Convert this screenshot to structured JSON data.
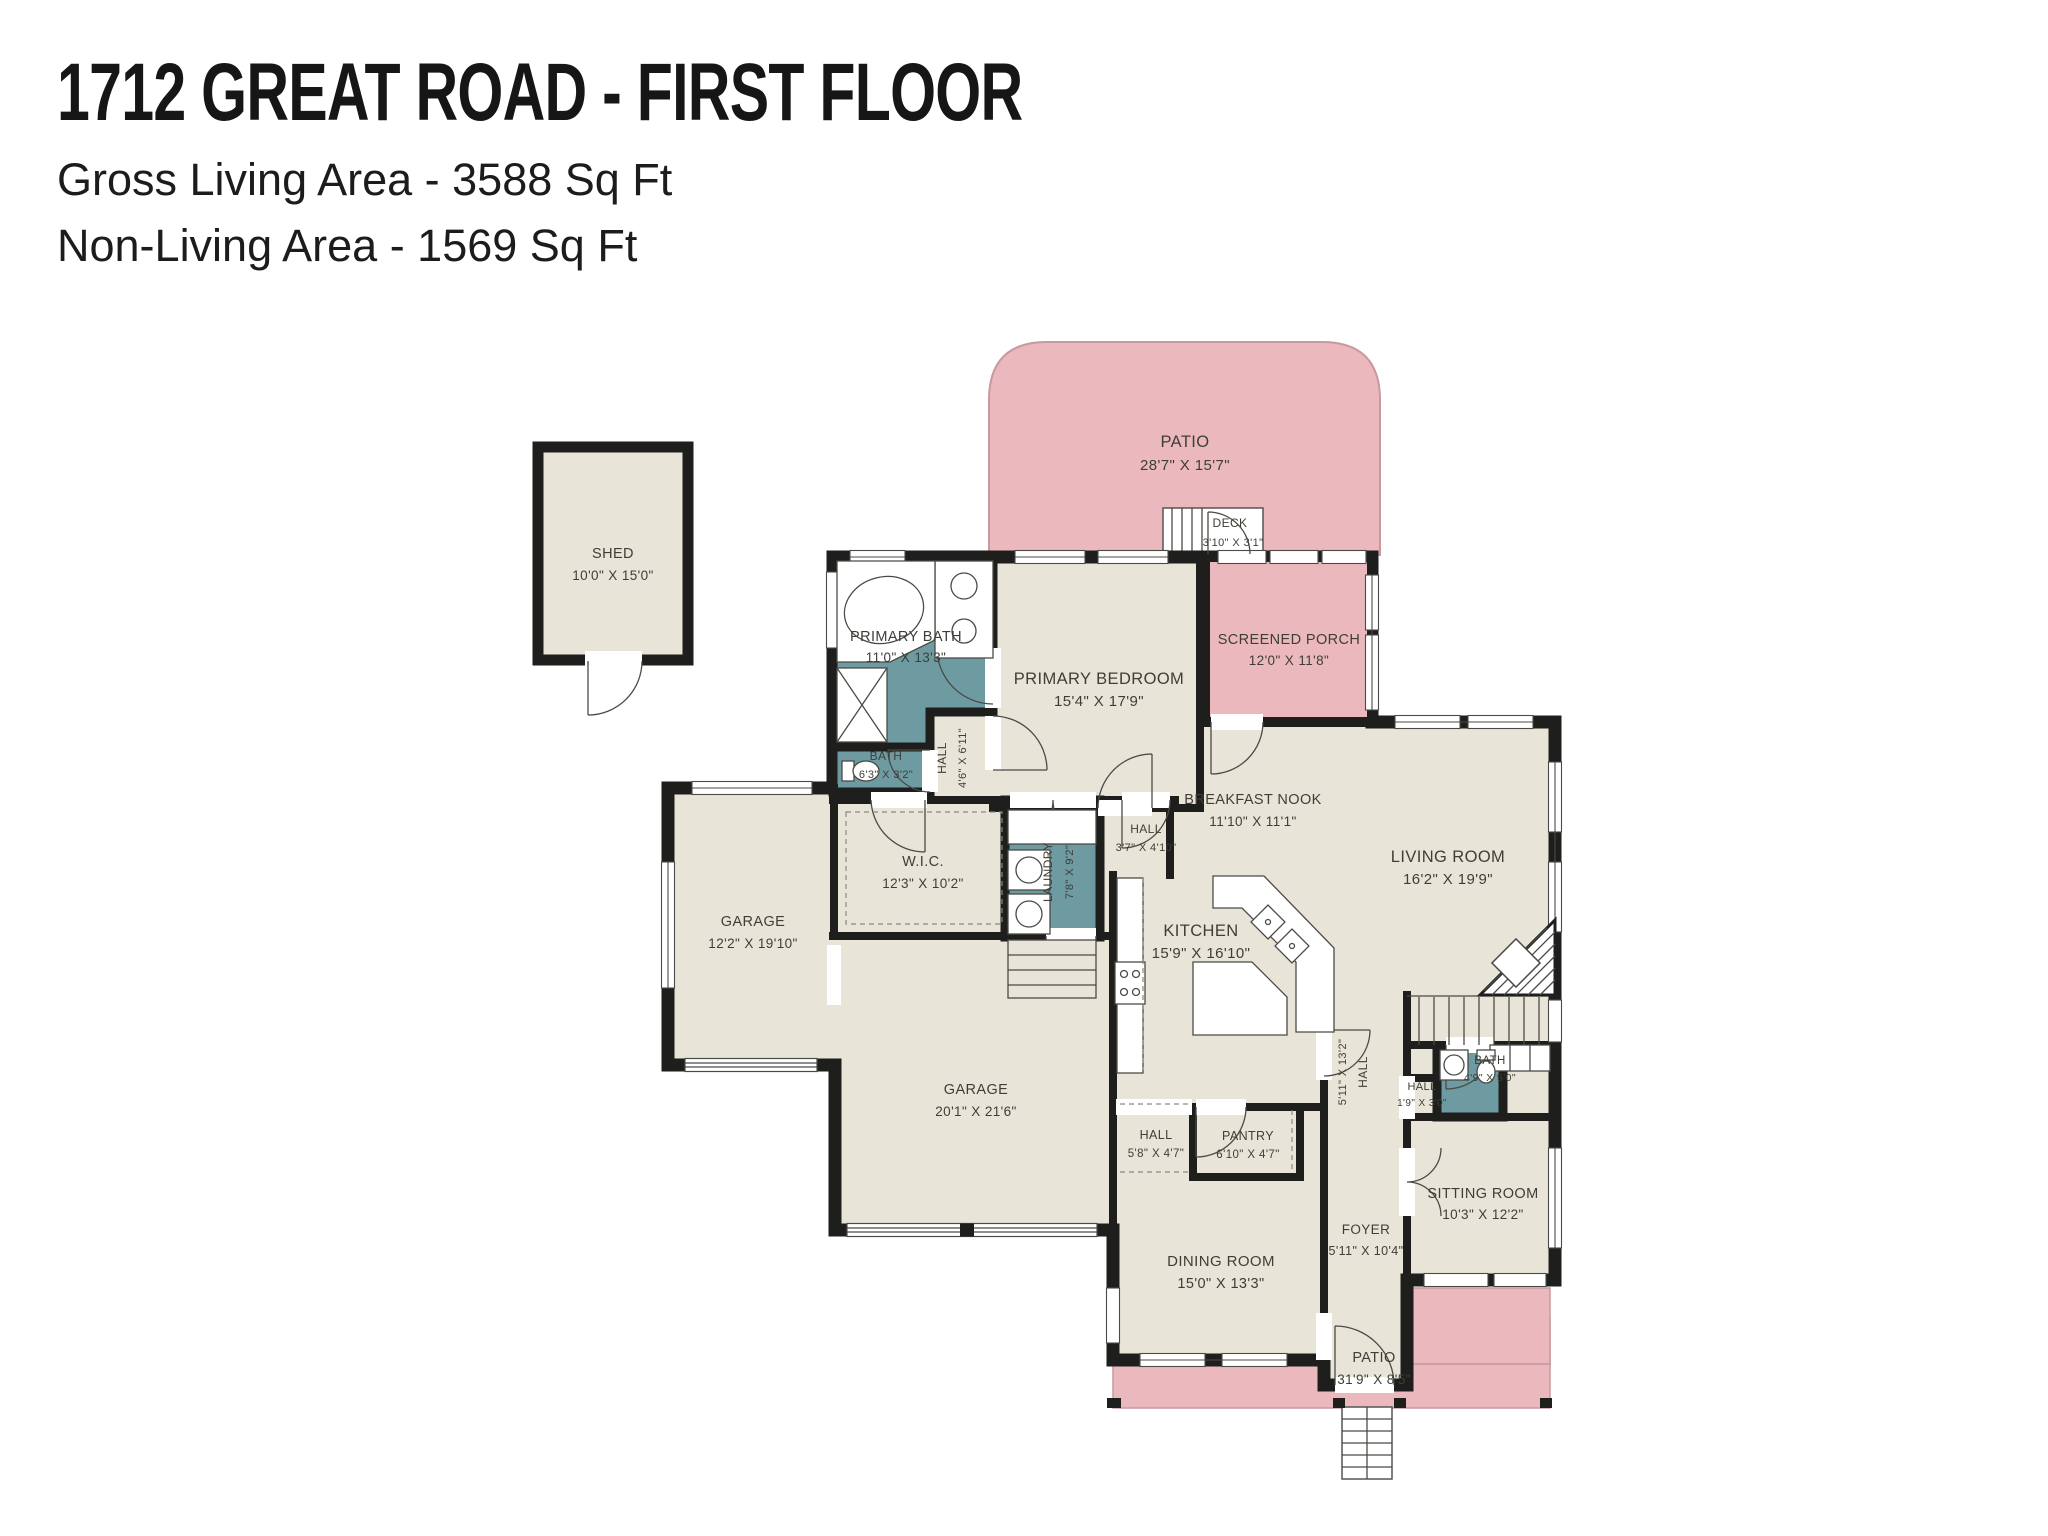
{
  "header": {
    "title": "1712 GREAT ROAD - FIRST FLOOR",
    "gross_living": "Gross Living Area - 3588 Sq Ft",
    "non_living": "Non-Living Area - 1569 Sq Ft"
  },
  "rooms": {
    "shed": {
      "name": "SHED",
      "dims": "10'0\" X 15'0\""
    },
    "patio_top": {
      "name": "PATIO",
      "dims": "28'7\" X 15'7\""
    },
    "deck": {
      "name": "DECK",
      "dims": "3'10\" X 3'1\""
    },
    "screened_porch": {
      "name": "SCREENED PORCH",
      "dims": "12'0\" X 11'8\""
    },
    "primary_bath": {
      "name": "PRIMARY BATH",
      "dims": "11'0\" X 13'3\""
    },
    "bath_upper": {
      "name": "BATH",
      "dims": "6'3\" X 3'2\""
    },
    "hall_primary": {
      "name": "HALL",
      "dims": "4'6\" X 6'11\""
    },
    "primary_bedroom": {
      "name": "PRIMARY BEDROOM",
      "dims": "15'4\" X 17'9\""
    },
    "wic": {
      "name": "W.I.C.",
      "dims": "12'3\" X 10'2\""
    },
    "laundry": {
      "name": "LAUNDRY",
      "dims": "7'8\" X 9'2\""
    },
    "hall_kitchen": {
      "name": "HALL",
      "dims": "3'7\" X 4'10\""
    },
    "breakfast_nook": {
      "name": "BREAKFAST NOOK",
      "dims": "11'10\" X 11'1\""
    },
    "living_room": {
      "name": "LIVING ROOM",
      "dims": "16'2\" X 19'9\""
    },
    "kitchen": {
      "name": "KITCHEN",
      "dims": "15'9\" X 16'10\""
    },
    "hall_center": {
      "name": "HALL",
      "dims": "5'11\" X 13'2\""
    },
    "hall_small": {
      "name": "HALL",
      "dims": "5'8\" X 4'7\""
    },
    "pantry": {
      "name": "PANTRY",
      "dims": "6'10\" X 4'7\""
    },
    "dining_room": {
      "name": "DINING ROOM",
      "dims": "15'0\" X 13'3\""
    },
    "foyer": {
      "name": "FOYER",
      "dims": "5'11\" X 10'4\""
    },
    "hall_tiny": {
      "name": "HALL",
      "dims": "1'9\" X 3'0\""
    },
    "bath_lower": {
      "name": "BATH",
      "dims": "4'9\" X 5'0\""
    },
    "sitting_room": {
      "name": "SITTING ROOM",
      "dims": "10'3\" X 12'2\""
    },
    "garage_left": {
      "name": "GARAGE",
      "dims": "12'2\" X 19'10\""
    },
    "garage_main": {
      "name": "GARAGE",
      "dims": "20'1\" X 21'6\""
    },
    "patio_bottom": {
      "name": "PATIO",
      "dims": "31'9\" X 8'5\""
    }
  },
  "colors": {
    "living_area": "#E9E4D8",
    "bath_area": "#6E9AA2",
    "outdoor_area": "#EBB9BD",
    "wall": "#1E1E1C"
  }
}
